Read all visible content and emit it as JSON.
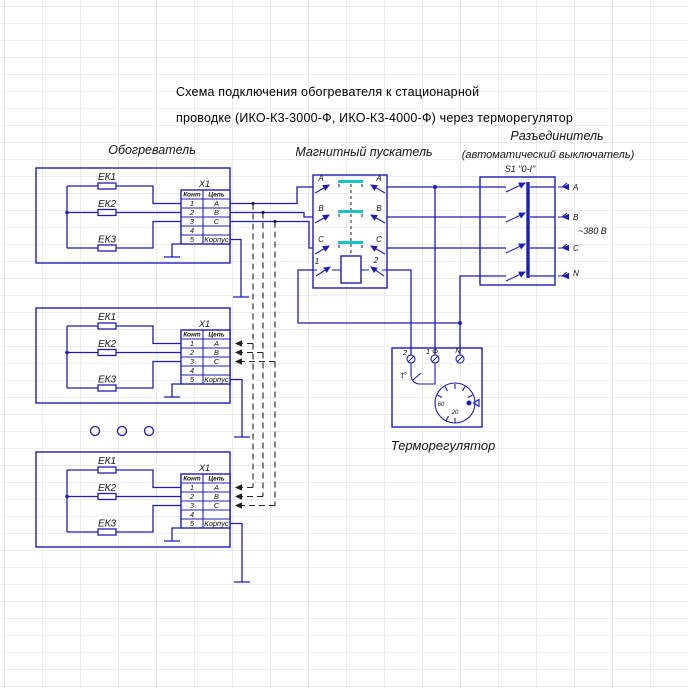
{
  "title": {
    "line1": "Схема подключения обогревателя к стационарной",
    "line2": "проводке (ИКО-К3-3000-Ф, ИКО-К3-4000-Ф) через терморегулятор"
  },
  "heater": {
    "label": "Обогреватель",
    "elements": [
      "ЕК1",
      "ЕК2",
      "ЕК3"
    ],
    "terminal_block": {
      "name": "X1",
      "col_headers": [
        "Конт",
        "Цепь"
      ],
      "rows": [
        {
          "pin": "1",
          "circuit": "А"
        },
        {
          "pin": "2",
          "circuit": "В"
        },
        {
          "pin": "3",
          "circuit": "С"
        },
        {
          "pin": "4",
          "circuit": ""
        },
        {
          "pin": "5",
          "circuit": "Корпус"
        }
      ]
    }
  },
  "starter": {
    "label": "Магнитный пускатель",
    "phases": [
      "А",
      "В",
      "С"
    ],
    "coil_terminals": [
      "1",
      "2"
    ]
  },
  "disconnector": {
    "label_line1": "Разъединитель",
    "label_line2": "(автоматический выключатель)",
    "switch_label": "S1 \"0-I\"",
    "terminals": [
      "А",
      "В",
      "С",
      "N"
    ],
    "voltage": "~380 В"
  },
  "thermostat": {
    "label": "Терморегулятор",
    "terminals": [
      "2",
      "1 Ф",
      "N"
    ],
    "contact_symbol": "t°",
    "dial_labels": [
      "60",
      "20"
    ]
  },
  "colors": {
    "wire": "#1c1cb8",
    "contact_bridge": "#18c4c4",
    "dashed_link": "#222222",
    "text": "#141414"
  }
}
